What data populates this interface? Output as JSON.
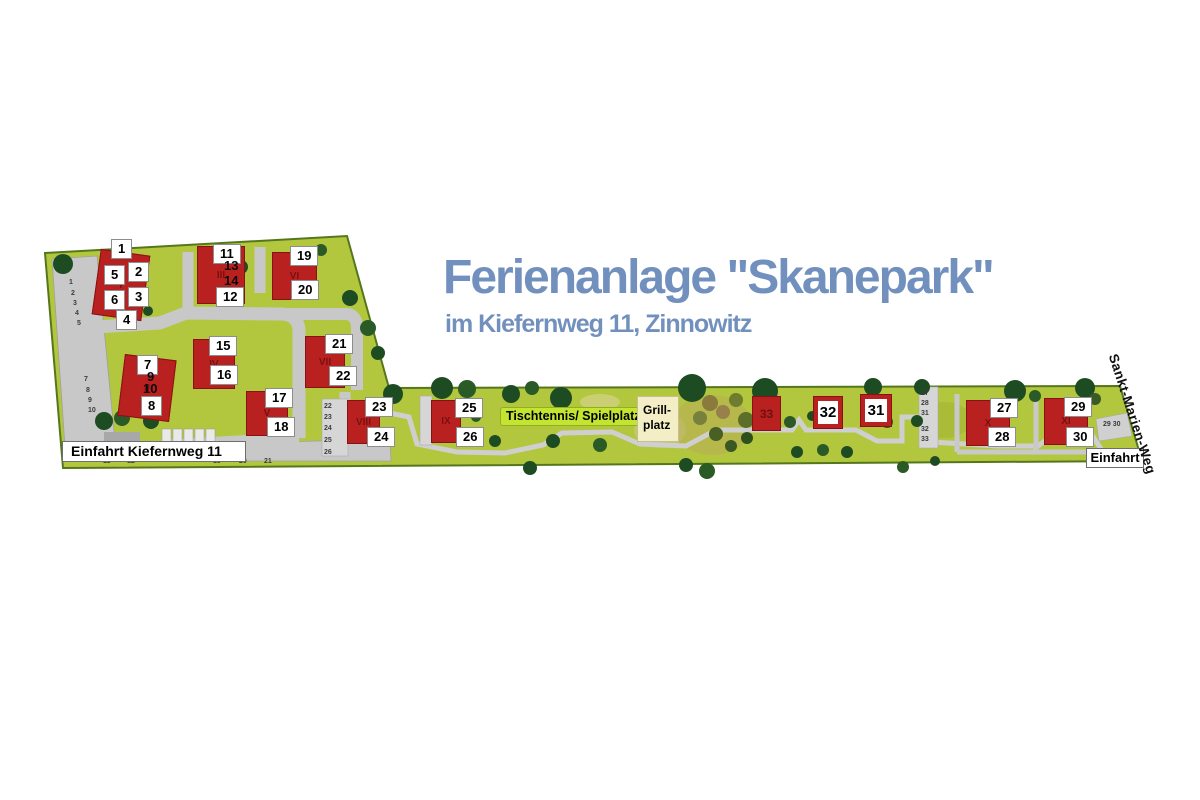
{
  "title": {
    "main": "Ferienanlage \"Skanepark\"",
    "subtitle": "im Kiefernweg 11, Zinnowitz"
  },
  "colors": {
    "title_blue": "#7290bd",
    "map_green": "#b3c73e",
    "building_red": "#b92121",
    "highlight_green": "#c3e431",
    "grill_beige": "#f4eec6"
  },
  "map": {
    "entrance_left_label": "Einfahrt Kiefernweg 11",
    "entrance_right_label": "Einfahrt",
    "street_label": "Sankt-Marien-Weg",
    "tischtennis_label": "Tischtennis/ Spielplatz",
    "grill_line1": "Grill-",
    "grill_line2": "platz",
    "buildings": [
      {
        "numeral": "I",
        "x": 96,
        "y": 252,
        "w": 50,
        "h": 66,
        "rot": 8,
        "style": "normal"
      },
      {
        "numeral": "II",
        "x": 121,
        "y": 357,
        "w": 52,
        "h": 62,
        "rot": 7,
        "style": "normal"
      },
      {
        "numeral": "III",
        "x": 197,
        "y": 246,
        "w": 48,
        "h": 58,
        "rot": 0,
        "style": "normal"
      },
      {
        "numeral": "IV",
        "x": 193,
        "y": 339,
        "w": 42,
        "h": 50,
        "rot": 0,
        "style": "normal"
      },
      {
        "numeral": "V",
        "x": 246,
        "y": 391,
        "w": 42,
        "h": 45,
        "rot": 0,
        "style": "normal"
      },
      {
        "numeral": "VI",
        "x": 272,
        "y": 252,
        "w": 45,
        "h": 48,
        "rot": 0,
        "style": "normal"
      },
      {
        "numeral": "VII",
        "x": 305,
        "y": 336,
        "w": 40,
        "h": 52,
        "rot": 0,
        "style": "normal"
      },
      {
        "numeral": "VIII",
        "x": 347,
        "y": 400,
        "w": 33,
        "h": 44,
        "rot": 0,
        "style": "normal"
      },
      {
        "numeral": "IX",
        "x": 431,
        "y": 400,
        "w": 30,
        "h": 43,
        "rot": 0,
        "style": "normal"
      },
      {
        "numeral": "X",
        "x": 966,
        "y": 400,
        "w": 44,
        "h": 46,
        "rot": 0,
        "style": "normal"
      },
      {
        "numeral": "XI",
        "x": 1044,
        "y": 398,
        "w": 44,
        "h": 47,
        "rot": 0,
        "style": "normal"
      },
      {
        "numeral": "33",
        "x": 752,
        "y": 396,
        "w": 29,
        "h": 35,
        "rot": 0,
        "style": "dark"
      },
      {
        "numeral": "32",
        "x": 813,
        "y": 396,
        "w": 30,
        "h": 33,
        "rot": 0,
        "style": "big"
      },
      {
        "numeral": "31",
        "x": 860,
        "y": 394,
        "w": 32,
        "h": 33,
        "rot": 0,
        "style": "big"
      }
    ],
    "unit_labels": [
      {
        "t": "1",
        "x": 111,
        "y": 239,
        "s": "box"
      },
      {
        "t": "5",
        "x": 104,
        "y": 265,
        "s": "box"
      },
      {
        "t": "2",
        "x": 128,
        "y": 262,
        "s": "box"
      },
      {
        "t": "3",
        "x": 128,
        "y": 287,
        "s": "box"
      },
      {
        "t": "6",
        "x": 104,
        "y": 290,
        "s": "box"
      },
      {
        "t": "4",
        "x": 116,
        "y": 310,
        "s": "box"
      },
      {
        "t": "7",
        "x": 137,
        "y": 355,
        "s": "box"
      },
      {
        "t": "9",
        "x": 147,
        "y": 370,
        "s": "plain"
      },
      {
        "t": "10",
        "x": 143,
        "y": 382,
        "s": "plain"
      },
      {
        "t": "8",
        "x": 141,
        "y": 396,
        "s": "box"
      },
      {
        "t": "11",
        "x": 213,
        "y": 244,
        "s": "box"
      },
      {
        "t": "13",
        "x": 224,
        "y": 259,
        "s": "plain"
      },
      {
        "t": "14",
        "x": 224,
        "y": 274,
        "s": "plain"
      },
      {
        "t": "12",
        "x": 216,
        "y": 287,
        "s": "box"
      },
      {
        "t": "15",
        "x": 209,
        "y": 336,
        "s": "box"
      },
      {
        "t": "16",
        "x": 210,
        "y": 365,
        "s": "box"
      },
      {
        "t": "17",
        "x": 265,
        "y": 388,
        "s": "box"
      },
      {
        "t": "18",
        "x": 267,
        "y": 417,
        "s": "box"
      },
      {
        "t": "19",
        "x": 290,
        "y": 246,
        "s": "box"
      },
      {
        "t": "20",
        "x": 291,
        "y": 280,
        "s": "box"
      },
      {
        "t": "21",
        "x": 325,
        "y": 334,
        "s": "box"
      },
      {
        "t": "22",
        "x": 329,
        "y": 366,
        "s": "box"
      },
      {
        "t": "23",
        "x": 365,
        "y": 397,
        "s": "box"
      },
      {
        "t": "24",
        "x": 367,
        "y": 427,
        "s": "box"
      },
      {
        "t": "25",
        "x": 455,
        "y": 398,
        "s": "box"
      },
      {
        "t": "26",
        "x": 456,
        "y": 427,
        "s": "box"
      },
      {
        "t": "27",
        "x": 990,
        "y": 398,
        "s": "box"
      },
      {
        "t": "28",
        "x": 988,
        "y": 427,
        "s": "box"
      },
      {
        "t": "29",
        "x": 1064,
        "y": 397,
        "s": "box"
      },
      {
        "t": "30",
        "x": 1066,
        "y": 427,
        "s": "box"
      }
    ],
    "parking_labels": [
      {
        "t": "1",
        "x": 69,
        "y": 279
      },
      {
        "t": "2",
        "x": 71,
        "y": 290
      },
      {
        "t": "3",
        "x": 73,
        "y": 300
      },
      {
        "t": "4",
        "x": 75,
        "y": 310
      },
      {
        "t": "5",
        "x": 77,
        "y": 320
      },
      {
        "t": "7",
        "x": 84,
        "y": 376
      },
      {
        "t": "8",
        "x": 86,
        "y": 387
      },
      {
        "t": "9",
        "x": 88,
        "y": 397
      },
      {
        "t": "10",
        "x": 88,
        "y": 407
      },
      {
        "t": "11",
        "x": 103,
        "y": 458
      },
      {
        "t": "12",
        "x": 127,
        "y": 458
      },
      {
        "t": "19",
        "x": 213,
        "y": 458
      },
      {
        "t": "20",
        "x": 239,
        "y": 458
      },
      {
        "t": "21",
        "x": 264,
        "y": 458
      },
      {
        "t": "22",
        "x": 324,
        "y": 403
      },
      {
        "t": "23",
        "x": 324,
        "y": 414
      },
      {
        "t": "24",
        "x": 324,
        "y": 425
      },
      {
        "t": "25",
        "x": 324,
        "y": 437
      },
      {
        "t": "26",
        "x": 324,
        "y": 449
      },
      {
        "t": "27",
        "x": 921,
        "y": 390
      },
      {
        "t": "28",
        "x": 921,
        "y": 400
      },
      {
        "t": "31",
        "x": 921,
        "y": 410
      },
      {
        "t": "32",
        "x": 921,
        "y": 426
      },
      {
        "t": "33",
        "x": 921,
        "y": 436
      },
      {
        "t": "29 30",
        "x": 1103,
        "y": 421
      }
    ]
  }
}
